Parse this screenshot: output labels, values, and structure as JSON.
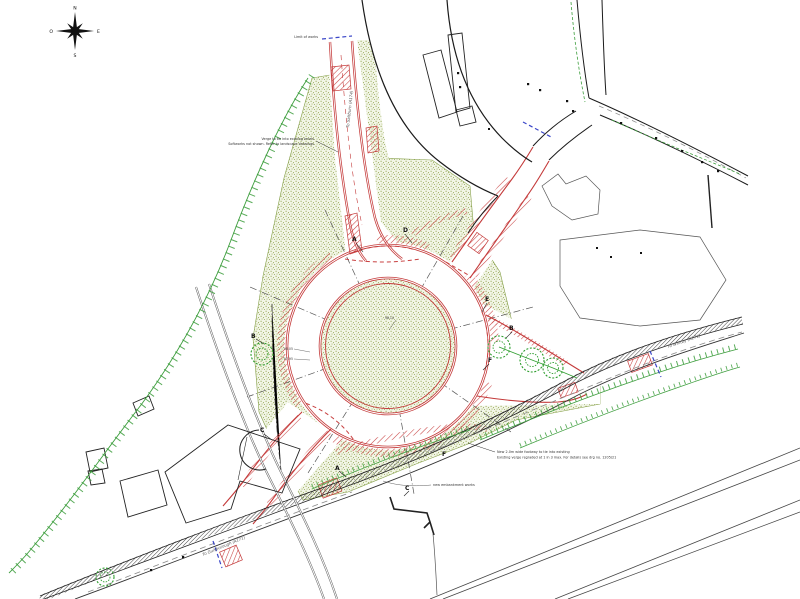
{
  "drawing": {
    "compass": {
      "n": "N",
      "s": "S",
      "e": "E",
      "w": "O"
    },
    "sections": {
      "a": "A",
      "b": "B",
      "c": "C",
      "d": "D",
      "e": "E",
      "f": "F"
    },
    "road_labels": {
      "north": "To Saltburn (A174)",
      "east": "To Whitby (A171)",
      "west": "To Guisborough (A171)"
    },
    "notes": {
      "verge_line1": "Verge to tie into existing levels",
      "verge_line2": "Softworks not shown. Refer to landscape drawings",
      "footway_line1": "New 2.0m wide footway to tie into existing",
      "footway_line2": "Existing verge regraded at 1 in 3 max. For details see drg no. 1205/21",
      "embankment": "new embankment works",
      "limit": "Limit of works"
    },
    "levels": {
      "l1": "98.05",
      "l2": "97.95",
      "l3": "98.10"
    },
    "colors": {
      "kerb_red": "#c43a3a",
      "stipple_green": "#8aa044",
      "tree_green": "#2f9e2f",
      "limit_blue": "#3a46c8",
      "line_black": "#1a1a1a"
    }
  }
}
